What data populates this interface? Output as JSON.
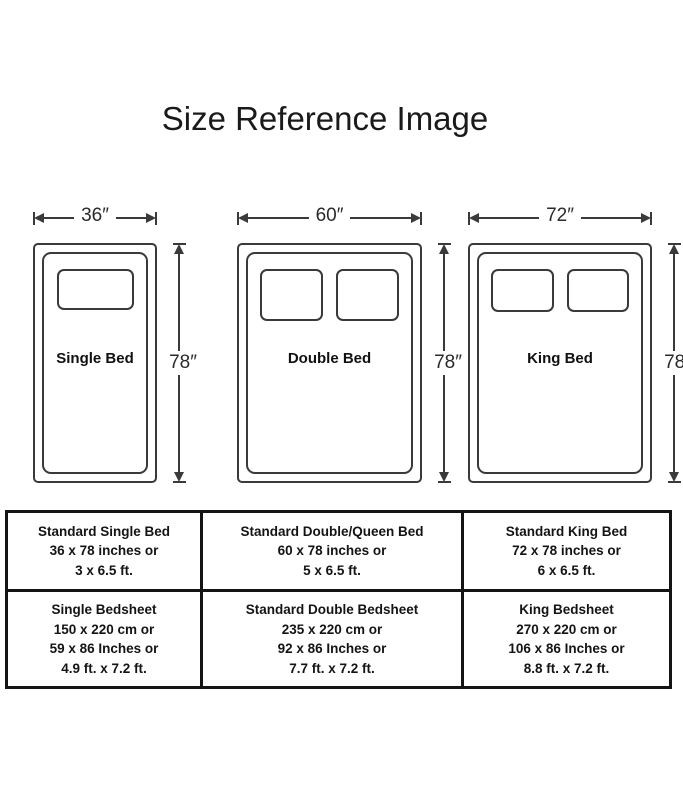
{
  "title": "Size Reference Image",
  "beds": [
    {
      "name": "Single Bed",
      "width_label": "36″",
      "height_label": "78″"
    },
    {
      "name": "Double Bed",
      "width_label": "60″",
      "height_label": "78″"
    },
    {
      "name": "King Bed",
      "width_label": "72″",
      "height_label": "78″"
    }
  ],
  "table": {
    "rows": [
      {
        "cells": [
          {
            "lines": [
              "Standard Single Bed",
              "36 x 78 inches or",
              "3 x 6.5 ft."
            ]
          },
          {
            "lines": [
              "Standard Double/Queen Bed",
              "60 x 78 inches or",
              "5 x 6.5 ft."
            ]
          },
          {
            "lines": [
              "Standard King Bed",
              "72 x 78 inches or",
              "6 x 6.5 ft."
            ]
          }
        ]
      },
      {
        "cells": [
          {
            "lines": [
              "Single Bedsheet",
              "150 x 220 cm or",
              "59 x 86 Inches or",
              "4.9 ft. x 7.2 ft."
            ]
          },
          {
            "lines": [
              "Standard Double Bedsheet",
              "235 x 220 cm or",
              "92 x 86 Inches or",
              "7.7 ft. x 7.2 ft."
            ]
          },
          {
            "lines": [
              "King Bedsheet",
              "270 x 220 cm or",
              "106 x 86 Inches or",
              "8.8 ft. x 7.2 ft."
            ]
          }
        ]
      }
    ]
  }
}
